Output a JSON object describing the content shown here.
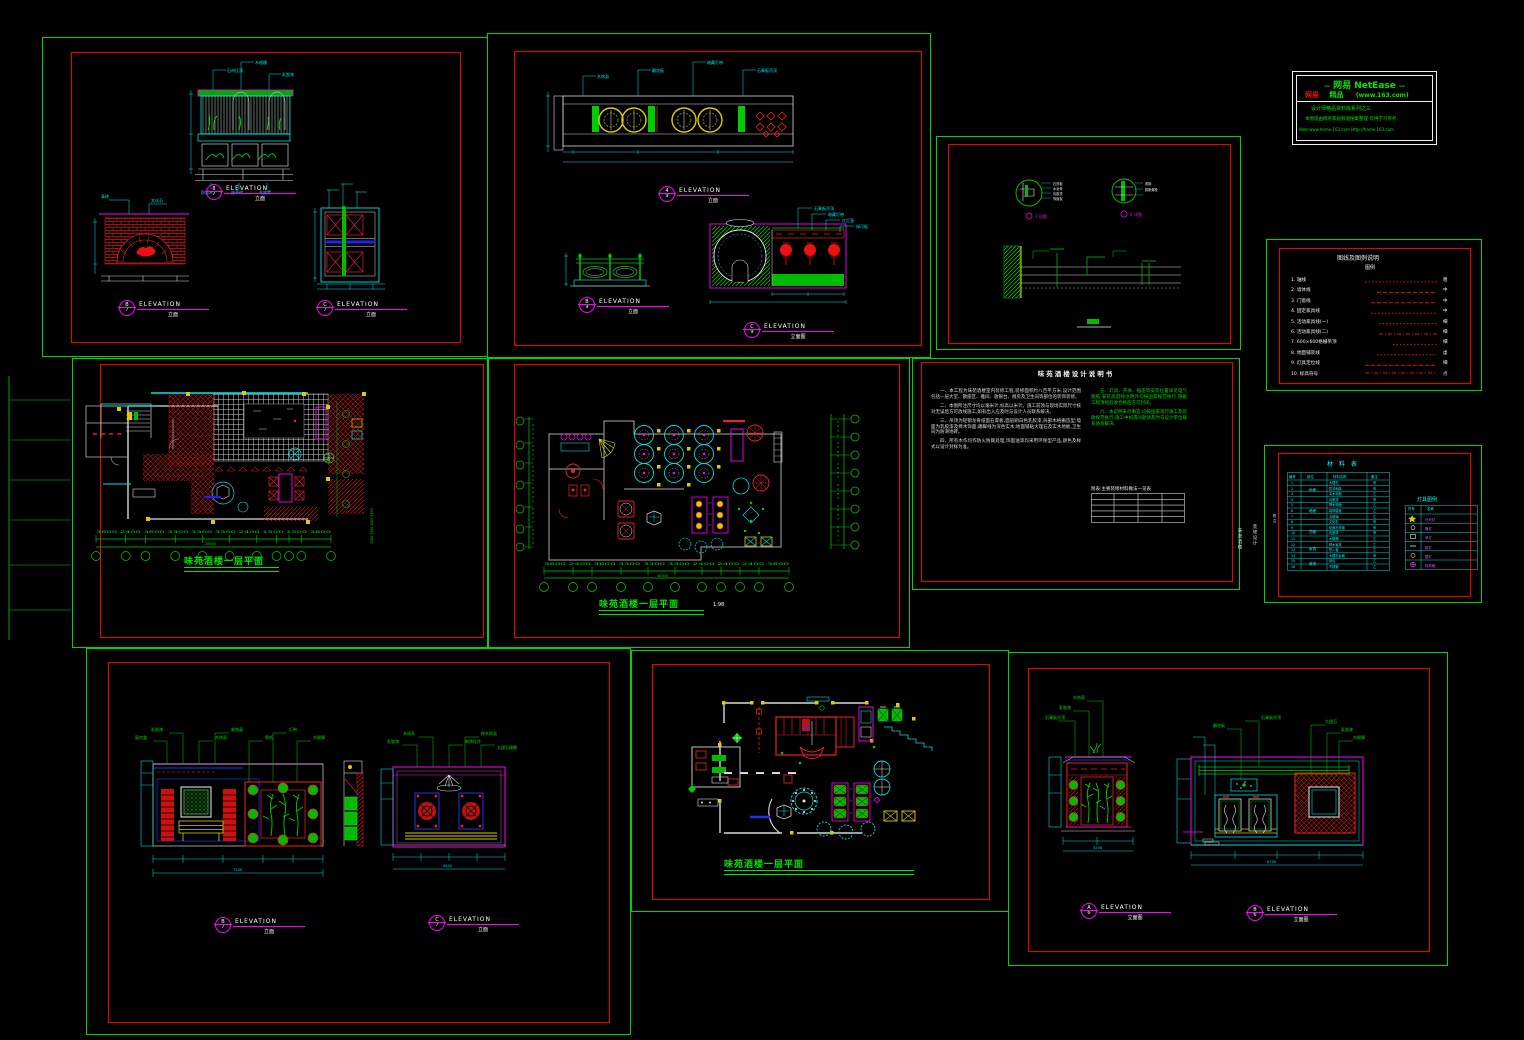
{
  "title_block": {
    "brand": "网易 NetEase",
    "dash_l": "—",
    "dash_r": "—",
    "sub_red": "网易",
    "sub_mid": "精品",
    "sub_site": "(www.163.com)",
    "line3": "设计师精品资料库系列之三",
    "line4": "本图纸由网易家居频道搜集整理 仅供学习参考",
    "line5": "Web:www.home.163.com  Http://home.163.com"
  },
  "side_labels": {
    "v1": "味苑酒楼",
    "v2": "装修设计",
    "v3": "施工图"
  },
  "sheet_a": {
    "elev1": {
      "num": "8",
      "den": "7",
      "label": "ELEVATION",
      "scale": "立面"
    },
    "elev2": {
      "num": "B",
      "den": "7",
      "label": "ELEVATION",
      "scale": "立面"
    },
    "elev3": {
      "num": "C",
      "den": "7",
      "label": "ELEVATION",
      "scale": "立面"
    },
    "ann": [
      "石材压顶",
      "木格栅",
      "乳胶漆",
      "防腐木",
      "嵌草砖",
      "青砖",
      "文化石",
      "木座凳"
    ]
  },
  "sheet_b": {
    "elev1": {
      "num": "4",
      "den": "9",
      "label": "ELEVATION",
      "scale": "立面"
    },
    "elev2": {
      "num": "B",
      "den": "9",
      "label": "ELEVATION",
      "scale": "立面"
    },
    "elev3": {
      "num": "C",
      "den": "9",
      "label": "ELEVATION",
      "scale": "立面图"
    },
    "ann": [
      "木饰面",
      "雕花板",
      "暗藏灯带",
      "石膏板吊顶",
      "红灯笼",
      "绿可板"
    ]
  },
  "sheet_c": {
    "tag1": "1 详图",
    "tag2": "2 详图",
    "ann": [
      "石膏板",
      "木龙骨",
      "乳胶漆",
      "饰面板",
      "角钢",
      "膨胀螺栓"
    ]
  },
  "legend": {
    "title": "图线及图例说明",
    "subtitle": "图例",
    "items": "1. 轴线\n2. 墙体线\n3. 门窗线\n4. 固定家具线\n5. 活动家具线(一)\n6. 活动家具线(二)\n7. 600×600格栅吊顶\n8. 地面铺装线\n9. 灯具定位线\n10. 标高符号",
    "codes": "粗\n中\n中\n中\n细\n细\n细\n虚\n细\n点"
  },
  "plan_e": {
    "title": "味苑酒楼一层平面",
    "dims": "3600 2400 3600 3300 3300 3300 2400 1500 1500 3600",
    "total": "28500",
    "side_dims": "3300 3300 4200 3300"
  },
  "plan_f": {
    "title": "味苑酒楼一层平面",
    "scale": "1:98",
    "dims": "3600 2400 3600 3300 3300 3300 2400 2400 2400 3600",
    "total": "30300",
    "left_dims": "2100 3300 2400 2400 3300 2100",
    "right_dims": "1500 2900 2900 4300 2900 1200"
  },
  "notes": {
    "title": "味苑酒楼设计说明书",
    "p1": "一、本工程为味苑酒楼室内装修工程,装修面积约八百平方米,设计范围包括一层大堂、散座区、雅间、收银台、厨房及卫生间等部位的装饰装修。",
    "p2": "二、本图所注尺寸均以毫米计,标高以米计。施工前须与现场实际尺寸核对无误后方可放线施工,如有出入应及时与设计人员联系解决。",
    "p3": "三、吊顶为轻钢龙骨纸面石膏板,面层刷白色乳胶漆,局部木格栅造型;墙面为乳胶漆及榉木饰面;踢脚线为深色实木;地面铺贴大理石及实木地板,卫生间为防滑地砖。",
    "p4": "四、所有木作均作防火防腐处理,饰面油漆均采用环保型产品,颜色及样式以设计封样为准。",
    "g1": "五、灯具、开关、插座等安装位置详见电气图纸,安装高度除注明外均按国家规范执行,隐蔽工程须经验收合格后方可封闭。",
    "g2": "六、本说明未尽事宜,均按国家现行施工及验收规范执行,施工中如遇问题请及时与设计单位联系协商解决。",
    "table_caption": "附表:主要装修材料做法一览表"
  },
  "schedule": {
    "title": "材 料 表",
    "headers": {
      "no": "编号",
      "zone": "部位",
      "name": "材料名称",
      "note": "备注"
    },
    "col_no": "1\n2\n3\n4\n5\n6\n7\n8\n9\n10\n11\n12\n13\n14\n15\n16",
    "zone1": "地面",
    "zone2": "墙面",
    "zone3": "顶面",
    "zone4": "家具",
    "zone5": "其他",
    "col_name": "大理石\n防滑地砖\n实木地板\n乳胶漆\n榉木饰面\n装饰壁纸\n清玻璃\n文化石\n纸面石膏板\n乳胶漆\n木格栅\n榉木家具\n防火板\n大理石台面\n软包\n不锈钢",
    "col_note": "甲\n甲\n乙\n甲\n乙\n乙\n乙\n甲\n甲\n甲\n乙\n乙\n乙\n甲\n乙\n乙",
    "side_note": "附注",
    "legend_title": "灯具图例",
    "legend_header_sym": "符号",
    "legend_header_name": "名称",
    "legend_names": "日光灯\n筒灯\n吊灯\n射灯\n壁灯\n排风扇"
  },
  "sheet_i": {
    "elev1": {
      "num": "B",
      "den": "7",
      "label": "ELEVATION",
      "scale": "立面"
    },
    "elev2": {
      "num": "C",
      "den": "7",
      "label": "ELEVATION",
      "scale": "立面"
    },
    "annL": [
      "窗帘盒",
      "乳胶漆",
      "木饰面",
      "装饰画",
      "壁纸",
      "灯带",
      "木踢脚"
    ],
    "annR": [
      "乳胶漆",
      "木线条",
      "装饰挂件",
      "榉木饰面",
      "大理石踢脚"
    ],
    "total1": "7200",
    "total2": "4600"
  },
  "plan_j": {
    "title": "味苑酒楼一层平面"
  },
  "sheet_k": {
    "elev1": {
      "num": "A",
      "den": "6",
      "label": "ELEVATION",
      "scale": "立面图"
    },
    "elev2": {
      "num": "B",
      "den": "6",
      "label": "ELEVATION",
      "scale": "立面图"
    },
    "ann": [
      "石膏板吊顶",
      "乳胶漆",
      "木饰面",
      "雕花板",
      "大理石",
      "木踢脚"
    ],
    "total1": "3200",
    "total2": "8700"
  }
}
